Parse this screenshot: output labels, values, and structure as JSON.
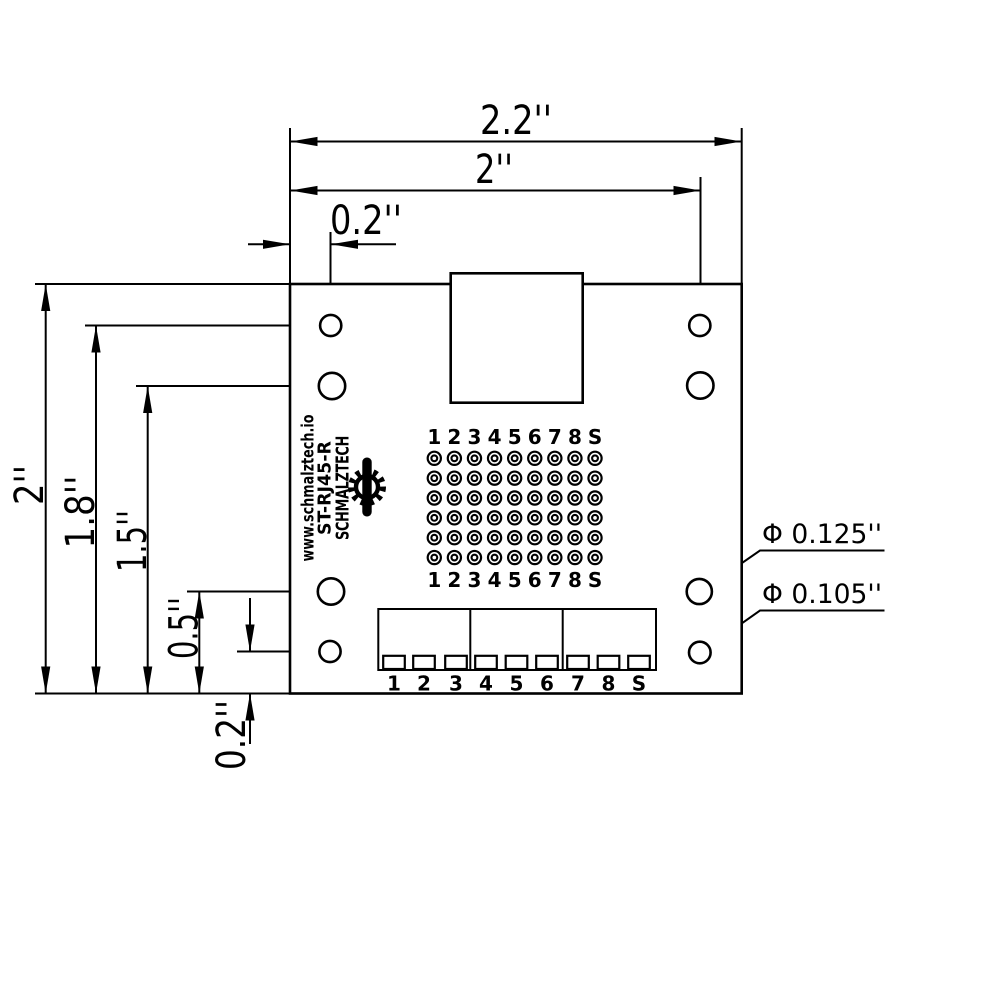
{
  "dims": {
    "top_overall": "2.2''",
    "top_to_hole_col": "2''",
    "top_hole_offset": "0.2''",
    "left_overall": "2''",
    "left_hole_row1": "1.8''",
    "left_hole_row2": "1.5''",
    "left_hole_row3": "0.5''",
    "left_hole_offset": "0.2''"
  },
  "callouts": {
    "large_hole": "Φ 0.125''",
    "small_hole": "Φ 0.105''"
  },
  "silkscreen": {
    "brand": "SCHMALZTECH",
    "part_number": "ST-RJ45-R",
    "website": "www.schmalztech.io"
  },
  "pad_labels": [
    "1",
    "2",
    "3",
    "4",
    "5",
    "6",
    "7",
    "8",
    "S"
  ],
  "terminal_labels": [
    "1",
    "2",
    "3",
    "4",
    "5",
    "6",
    "7",
    "8",
    "S"
  ],
  "colors": {
    "line": "#000000",
    "background": "#ffffff"
  }
}
